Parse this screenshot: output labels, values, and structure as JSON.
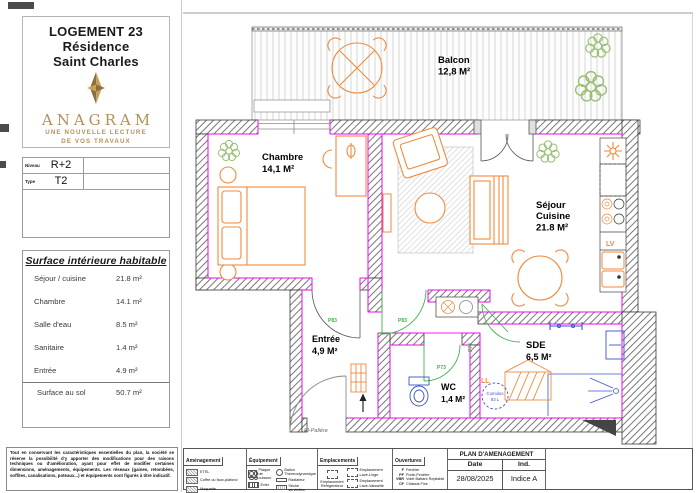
{
  "sidebar": {
    "title_lines": [
      "LOGEMENT 23",
      "Résidence",
      "Saint Charles"
    ],
    "brand": {
      "name": "ANAGRAM",
      "tagline_l1": "UNE NOUVELLE LECTURE",
      "tagline_l2": "DE VOS TRAVAUX"
    },
    "level": {
      "label": "Niveau",
      "value": "R+2"
    },
    "type": {
      "label": "Type",
      "value": "T2"
    },
    "surface": {
      "title": "Surface intérieure habitable",
      "rows": [
        {
          "label": "Séjour / cuisine",
          "value": "21.8 m²"
        },
        {
          "label": "Chambre",
          "value": "14.1 m²"
        },
        {
          "label": "Salle d'eau",
          "value": "8.5 m²"
        },
        {
          "label": "Sanitaire",
          "value": "1.4 m²"
        },
        {
          "label": "Entrée",
          "value": "4.9 m²"
        }
      ],
      "total": {
        "label": "Surface au sol",
        "value": "50.7 m²"
      }
    },
    "disclaimer": "Tout en conservant les caractéristiques essentielles du plan, la société se réserve la possibilité d'y apporter des modifications pour des raisons techniques ou d'amélioration, ayant pour effet de modifier certaines dimensions, aménagements, équipements. Les réseaux (gaines, retombées, soffites, canalisations, poteaux...) et équipements sont figurés à titre indicatif."
  },
  "plan": {
    "rooms": {
      "balcon": {
        "name": "Balcon",
        "area": "12,8 M²"
      },
      "chambre": {
        "name": "Chambre",
        "area": "14,1 M²"
      },
      "sejour": {
        "name_l1": "Séjour",
        "name_l2": "Cuisine",
        "area": "21.8 M²"
      },
      "entree": {
        "name": "Entrée",
        "area": "4,9 M²"
      },
      "wc": {
        "name": "WC",
        "area": "1,4 M²"
      },
      "sde": {
        "name": "SDE",
        "area": "6,5 M²"
      }
    },
    "labels": {
      "door_chambre": "P83",
      "door_sejour": "P83",
      "door_wc": "P73",
      "door_sde": "P73",
      "lv": "LV",
      "ll": "LL",
      "cumulus_l1": "Cumulus",
      "cumulus_l2": "93 L",
      "palier": "Pl-Palière"
    }
  },
  "legend": {
    "amenagement": {
      "title": "Aménagement",
      "items": [
        "ETEL",
        "Coffre ou faux-plafond",
        "Moquette"
      ]
    },
    "equipement": {
      "title": "Équipement",
      "items": [
        "Plaque de cuisson",
        "Évier",
        "Ballon Thermodynamique",
        "Radiateur",
        "Sèche serviettes"
      ]
    },
    "emplacements": {
      "title": "Emplacements",
      "items": [
        "Emplacement Réfrigérateur",
        "Emplacement Lave-Linge",
        "Emplacement Lave-Vaisselle"
      ]
    },
    "ouvertures": {
      "title": "Ouvertures",
      "items": [
        {
          "abbr": "F",
          "label": "Fenêtre"
        },
        {
          "abbr": "PF",
          "label": "Porte-Fenêtre"
        },
        {
          "abbr": "VBR",
          "label": "Volet Battant Repliable"
        },
        {
          "abbr": "CF",
          "label": "Châssis Fixe"
        }
      ]
    },
    "title_block": {
      "title": "PLAN D'AMENAGEMENT",
      "date_label": "Date",
      "date_value": "28/08/2025",
      "ind_label": "Ind.",
      "ind_value": "Indice A"
    }
  },
  "colors": {
    "furniture_orange": "#f08a3c",
    "insulation_magenta": "#ff00ff",
    "door_green": "#3cb54a",
    "fixture_blue": "#3a56c9",
    "plant_green": "#9abf75",
    "brand_gold": "#b3905a"
  }
}
